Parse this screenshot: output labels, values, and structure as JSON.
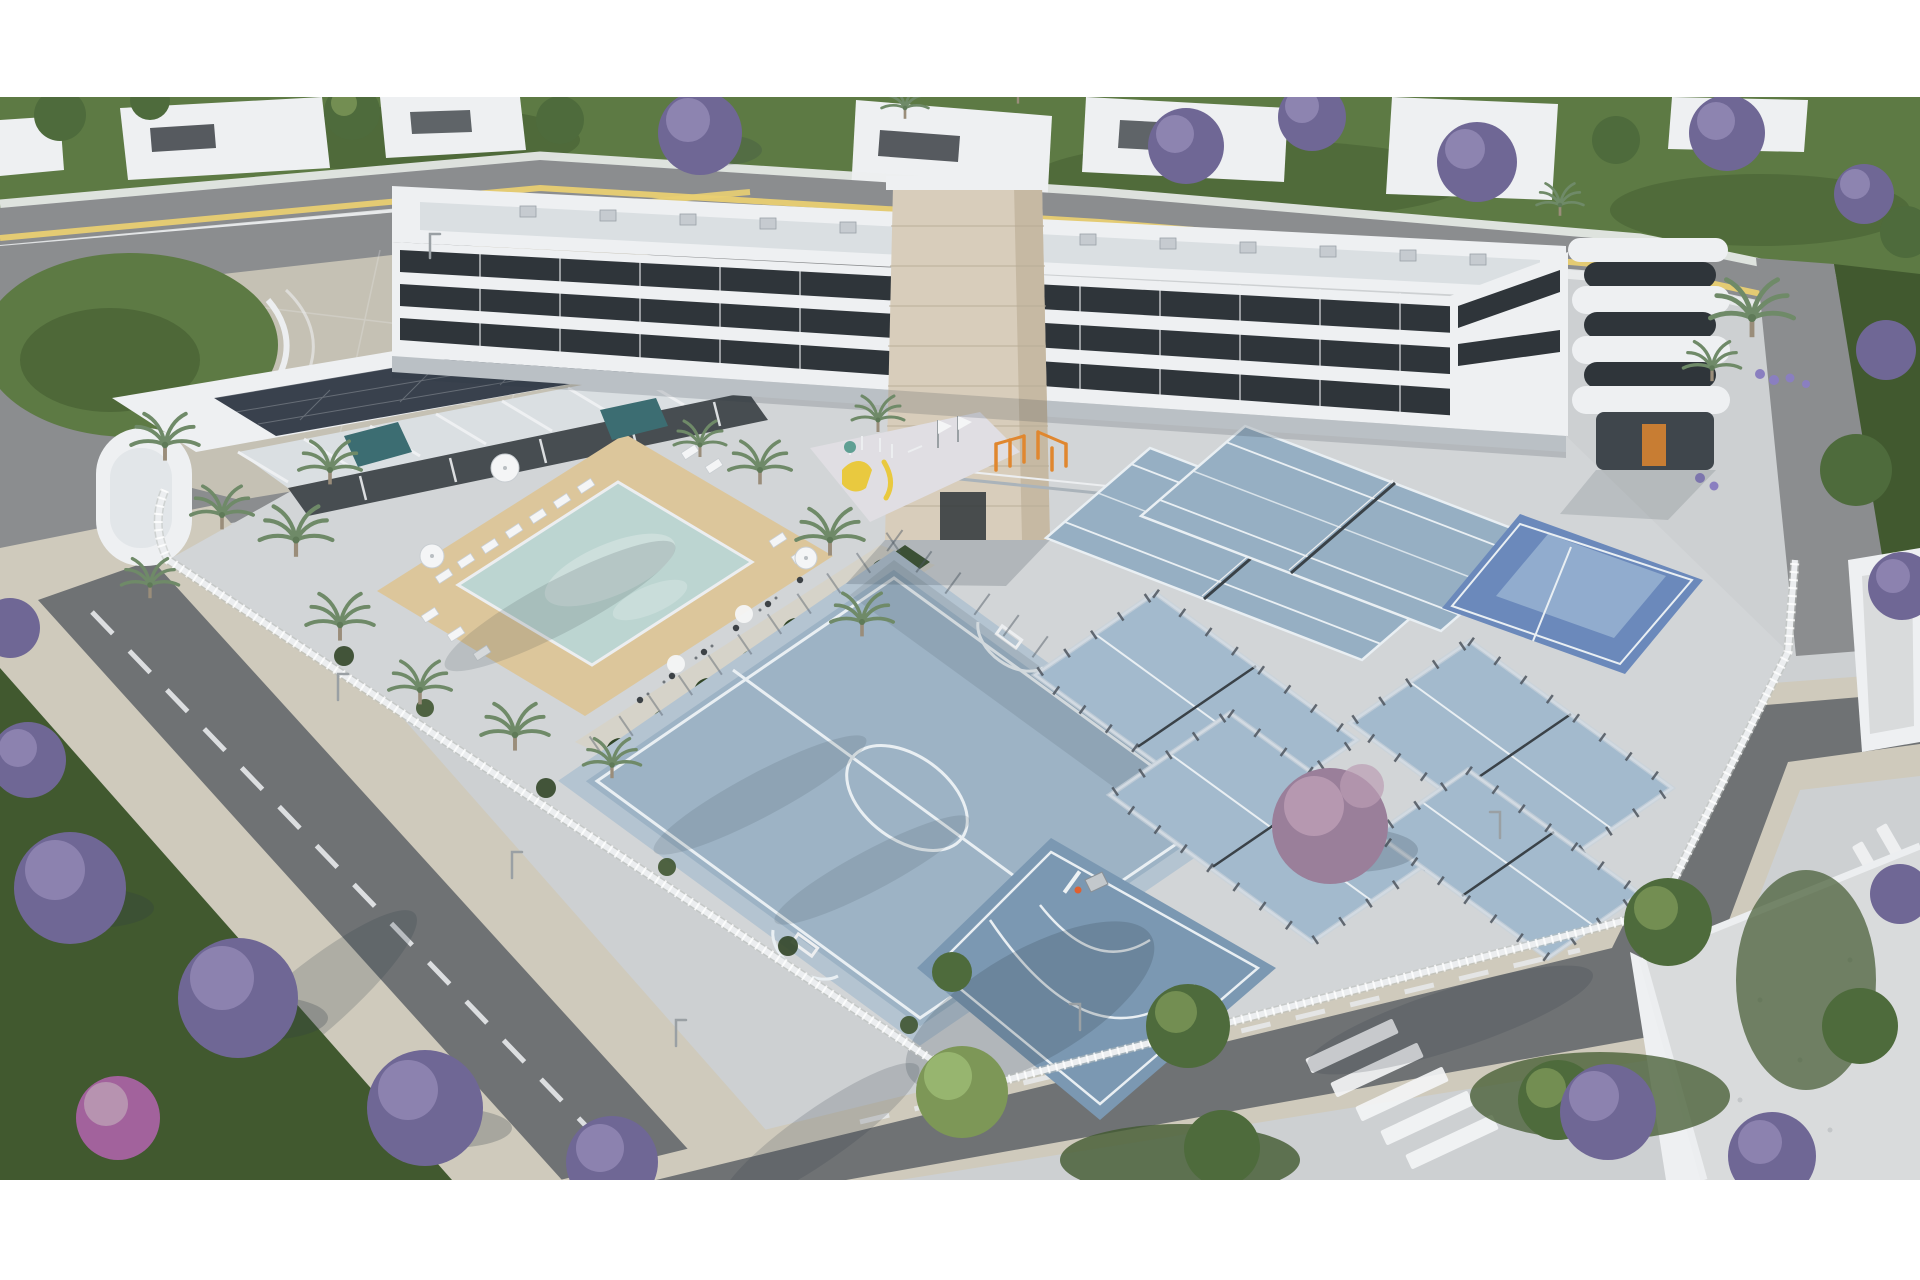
{
  "scene": {
    "title": "Aerial 3D architectural render of a residential complex with pool and sports courts",
    "format": {
      "letterbox_top_px": 97,
      "letterbox_bottom_px": 100,
      "width_px": 1920,
      "height_px": 1280
    },
    "features": [
      "apartment-building",
      "stone-clad-tower",
      "rounded-corner-tower",
      "low-wing-with-solar-panels",
      "swimming-pool",
      "spa-pools",
      "sun-loungers",
      "parasols",
      "dining-terrace",
      "palm-trees",
      "playground",
      "calisthenics-area",
      "futsal-court",
      "basketball-half-court",
      "padel-courts",
      "tennis-courts",
      "blue-multisport-court",
      "white-perimeter-fence",
      "jacaranda-trees",
      "streets-with-zebra-crossing",
      "yellow-road-marking",
      "neighbor-houses",
      "gravel-roof-buildings",
      "grass-oval-island"
    ],
    "palette": {
      "letterbox": "#ffffff",
      "concrete": "#cdd0d2",
      "courtyard": "#d2d5d7",
      "plaza": "#c5c1b4",
      "paving": "#d6d3c9",
      "sidewalk": "#cfcabc",
      "asphalt": "#8b8d8f",
      "asphalt_dark": "#6f7274",
      "road_line": "#e8eaec",
      "yellow_line": "#e9cf72",
      "grass": "#5d7a44",
      "grass_dark": "#41592f",
      "hedge": "#3f5531",
      "hedge_dark": "#324628",
      "building_white": "#eef0f2",
      "building_shade": "#dadfe2",
      "building_dark": "#3f464c",
      "window_dark": "#2f353a",
      "stone": "#d8cdbb",
      "stone_shade": "#c6b9a3",
      "stone_joint": "#b8ac96",
      "solar": "#39414d",
      "fence": "#eceef0",
      "glass": "#c7d2da",
      "padel_frame": "#4d555e",
      "net": "#3a4248",
      "pool": "#bcd5d1",
      "spa": "#3c6d72",
      "sand": "#dcc69b",
      "lounger": "#f4f5f6",
      "playground": "#e0dee3",
      "court": "#9db3c5",
      "court_line": "#e9eff3",
      "court_border": "#b4c4d1",
      "bball": "#7b98b2",
      "padel": "#a3bacd",
      "tennis": "#96afc3",
      "blue_court": "#6b89bb",
      "blue_panel": "#96b0d0",
      "gravel": "#d9dbdc",
      "orange": "#e0872f",
      "slide": "#e9c93f",
      "lavender": "#8a7fc0",
      "palm": "#6f8a68",
      "palm_trunk": "#9a8d7a",
      "tree_green": "#4e6b3c",
      "tree_green_light": "#7d9757",
      "jacaranda": "#6f6795",
      "jacaranda_light": "#938ab5",
      "pink_tree": "#9a7f9a",
      "pink_light": "#bb9cb4",
      "magenta": "#a2629c",
      "lamp": "#9aa0a4",
      "shadow": "#2e3a44"
    }
  }
}
